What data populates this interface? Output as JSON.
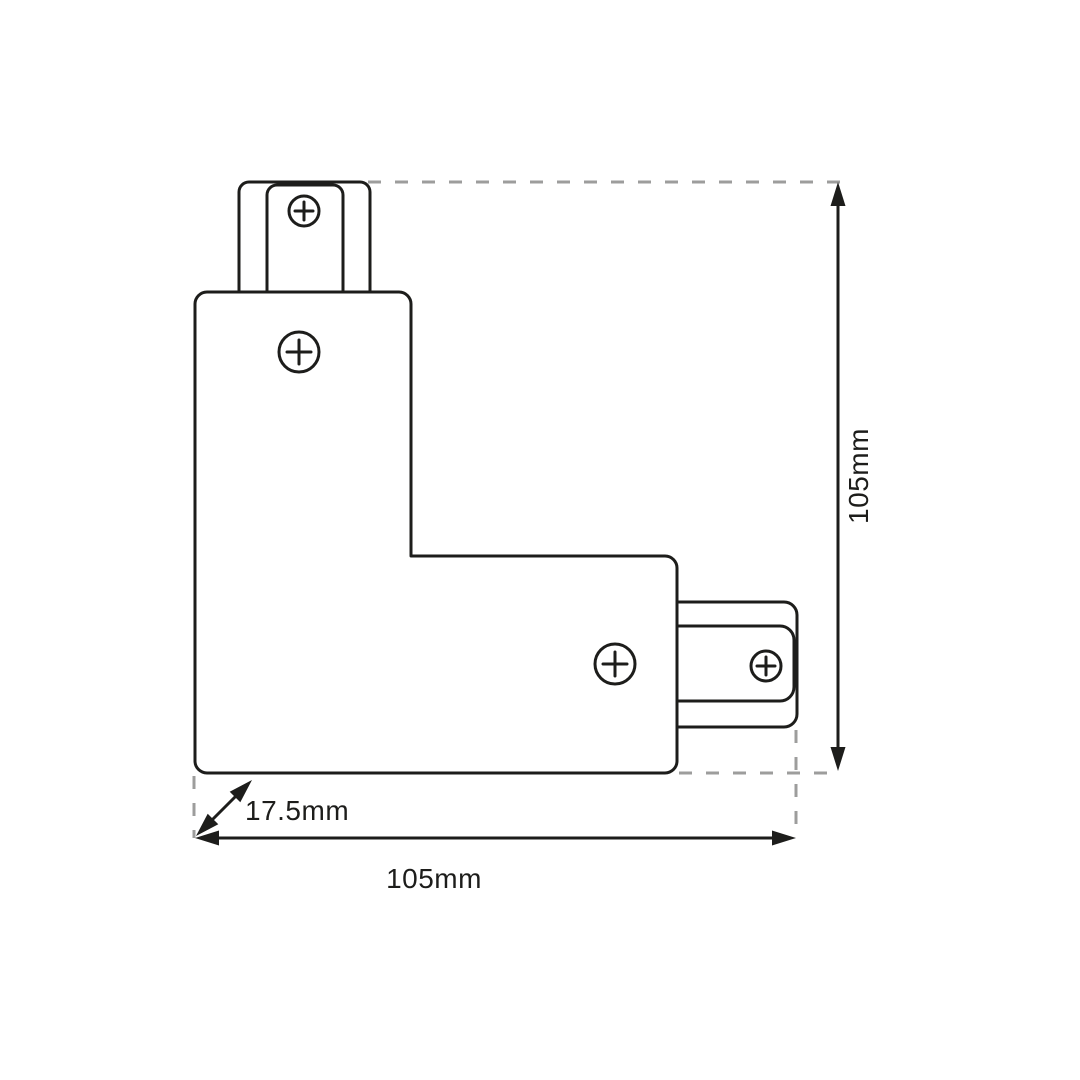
{
  "title": "L-shape track connector technical drawing",
  "drawing": {
    "labels": {
      "height": "105mm",
      "width": "105mm",
      "depth": "17.5mm"
    },
    "parts": {
      "body": "l-shaped-connector-body",
      "top_tab": "track-plug-top",
      "side_tab": "track-plug-right",
      "screw_count": 4
    }
  },
  "icons": {
    "screw": "circle-plus"
  },
  "colors": {
    "line": "#1d1d1b",
    "dashed": "#9d9d9c",
    "text": "#1d1d1b",
    "background": "#ffffff"
  }
}
